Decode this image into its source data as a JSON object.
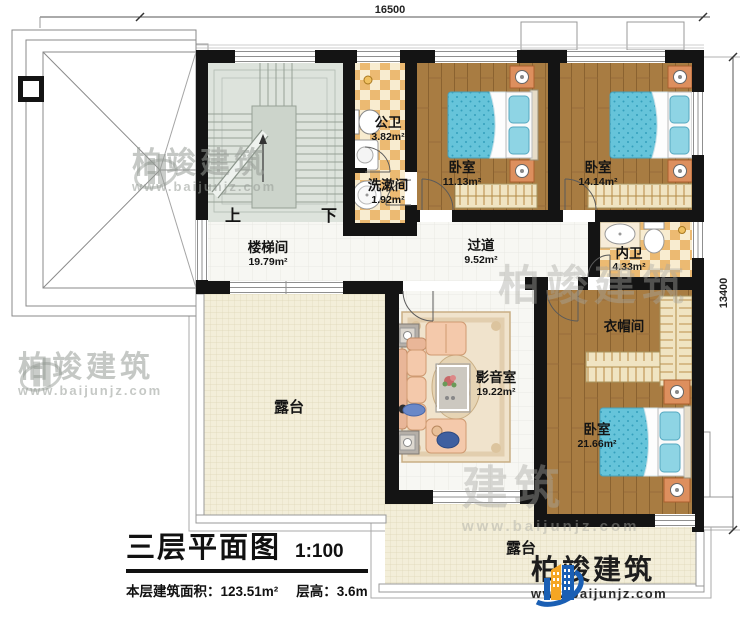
{
  "dimensions": {
    "width_label": "16500",
    "height_label": "13400"
  },
  "rooms": {
    "stairwell": {
      "name": "楼梯间",
      "area": "19.79m²"
    },
    "public_bath": {
      "name": "公卫",
      "area": "3.82m²"
    },
    "washroom": {
      "name": "洗漱间",
      "area": "1.92m²"
    },
    "bedroom_1": {
      "name": "卧室",
      "area": "11.13m²"
    },
    "bedroom_2": {
      "name": "卧室",
      "area": "14.14m²"
    },
    "corridor": {
      "name": "过道",
      "area": "9.52m²"
    },
    "ensuite_bath": {
      "name": "内卫",
      "area": "4.33m²"
    },
    "cloakroom": {
      "name": "衣帽间"
    },
    "bedroom_3": {
      "name": "卧室",
      "area": "21.66m²"
    },
    "media_room": {
      "name": "影音室",
      "area": "19.22m²"
    },
    "terrace_left": {
      "name": "露台"
    },
    "terrace_bottom": {
      "name": "露台"
    }
  },
  "stairs": {
    "up_label": "上",
    "down_label": "下"
  },
  "title_block": {
    "title": "三层平面图",
    "scale": "1:100",
    "floor_area": "本层建筑面积：123.51m²",
    "floor_height": "层高：3.6m"
  },
  "brand": {
    "name": "柏竣建筑",
    "website": "www.baijunjz.com"
  },
  "watermark": {
    "name": "柏竣建筑",
    "short_name": "建筑",
    "website": "www.baijunjz.com"
  },
  "colors": {
    "wall": "#141414",
    "wood_floor": "#a87c42",
    "tile_checker": "#ecba72",
    "terrace": "#f3eed9",
    "stair_floor": "#dde3dc",
    "mattress": "#66c4da",
    "brand_blue": "#1a5fb4",
    "brand_orange": "#f5a623"
  }
}
